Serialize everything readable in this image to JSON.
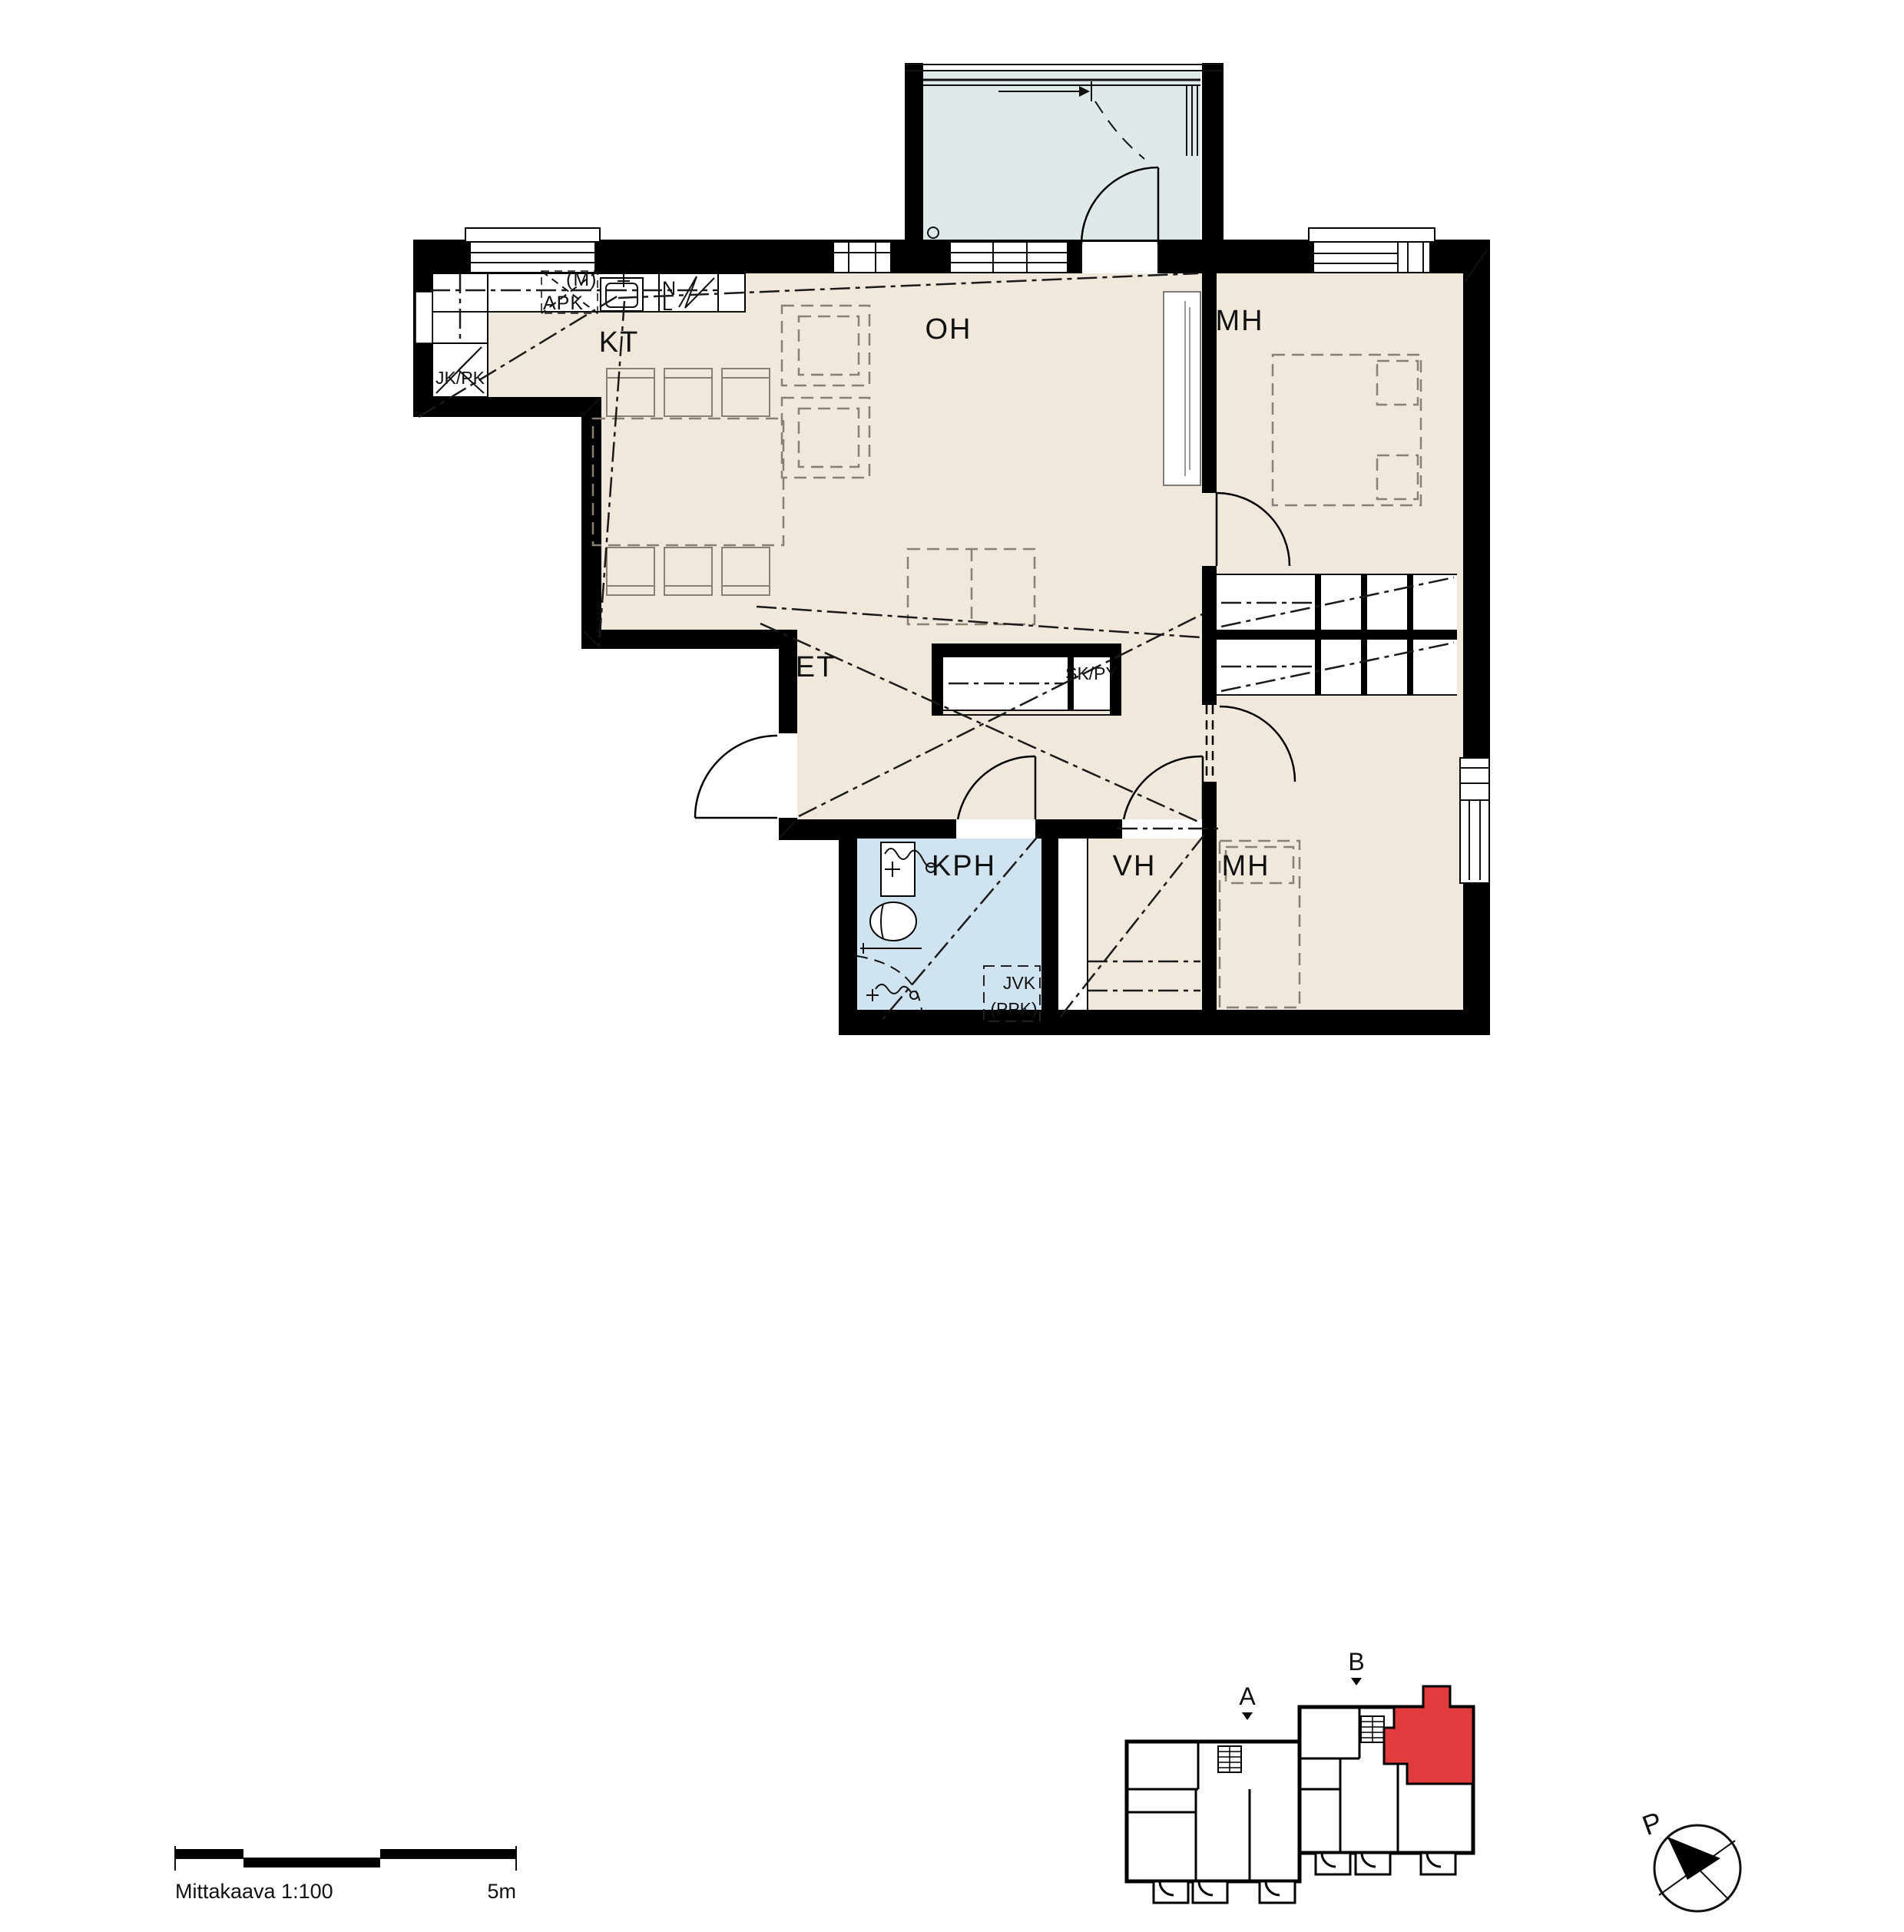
{
  "labels": {
    "kt": "KT",
    "oh": "OH",
    "mh_top": "MH",
    "mh_bottom": "MH",
    "et": "ET",
    "kph": "KPH",
    "vh": "VH",
    "sk_py": "SK/PY",
    "jk_pk": "JK/PK",
    "apk": "APK",
    "m": "(M)",
    "n": "N",
    "l": "L",
    "jvk": "JVK",
    "ppk": "(PPK)"
  },
  "scalebar": {
    "label": "Mittakaava 1:100",
    "length_label": "5m"
  },
  "locator": {
    "stair_a": "A",
    "stair_b": "B"
  },
  "compass": {
    "north": "P"
  },
  "colors": {
    "paper": "#ffffff",
    "wall": "#000000",
    "ink": "#111111",
    "floor": "#f1e8dc",
    "wet": "#cfe4f0",
    "balcony": "#dfe9ea",
    "highlight": "#e23b3e",
    "furniture": "#8a8072"
  }
}
